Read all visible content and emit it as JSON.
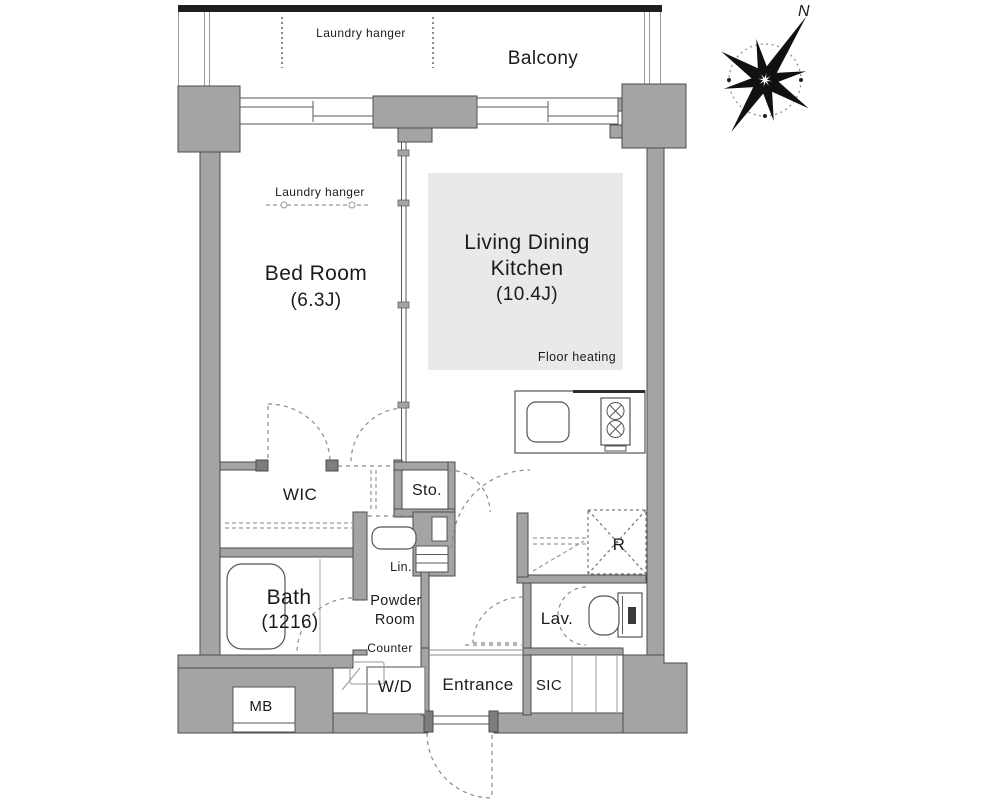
{
  "compass": {
    "north_label": "N"
  },
  "balcony": {
    "label": "Balcony",
    "laundry_hanger": "Laundry hanger"
  },
  "bedroom": {
    "name": "Bed Room",
    "size": "(6.3J)",
    "laundry_hanger": "Laundry hanger"
  },
  "ldk": {
    "name_line1": "Living Dining",
    "name_line2": "Kitchen",
    "size": "(10.4J)",
    "floor_heating": "Floor heating"
  },
  "storage": {
    "wic": "WIC",
    "sto": "Sto.",
    "lin": "Lin.",
    "sic": "SIC"
  },
  "bath": {
    "name": "Bath",
    "size": "(1216)"
  },
  "powder_room": {
    "name_line1": "Powder",
    "name_line2": "Room",
    "counter": "Counter",
    "washer_dryer": "W/D"
  },
  "lavatory": {
    "label": "Lav."
  },
  "entrance": {
    "label": "Entrance"
  },
  "utility": {
    "meter_box": "MB",
    "refrigerator": "R"
  },
  "colors": {
    "wall_fill": "#a4a4a4",
    "wall_stroke": "#4b4b4b",
    "floor_heating_fill": "#e9e9e9",
    "dashed_line": "#8a8a8a",
    "text": "#1b1b1b",
    "outline": "#1f1f1f"
  }
}
